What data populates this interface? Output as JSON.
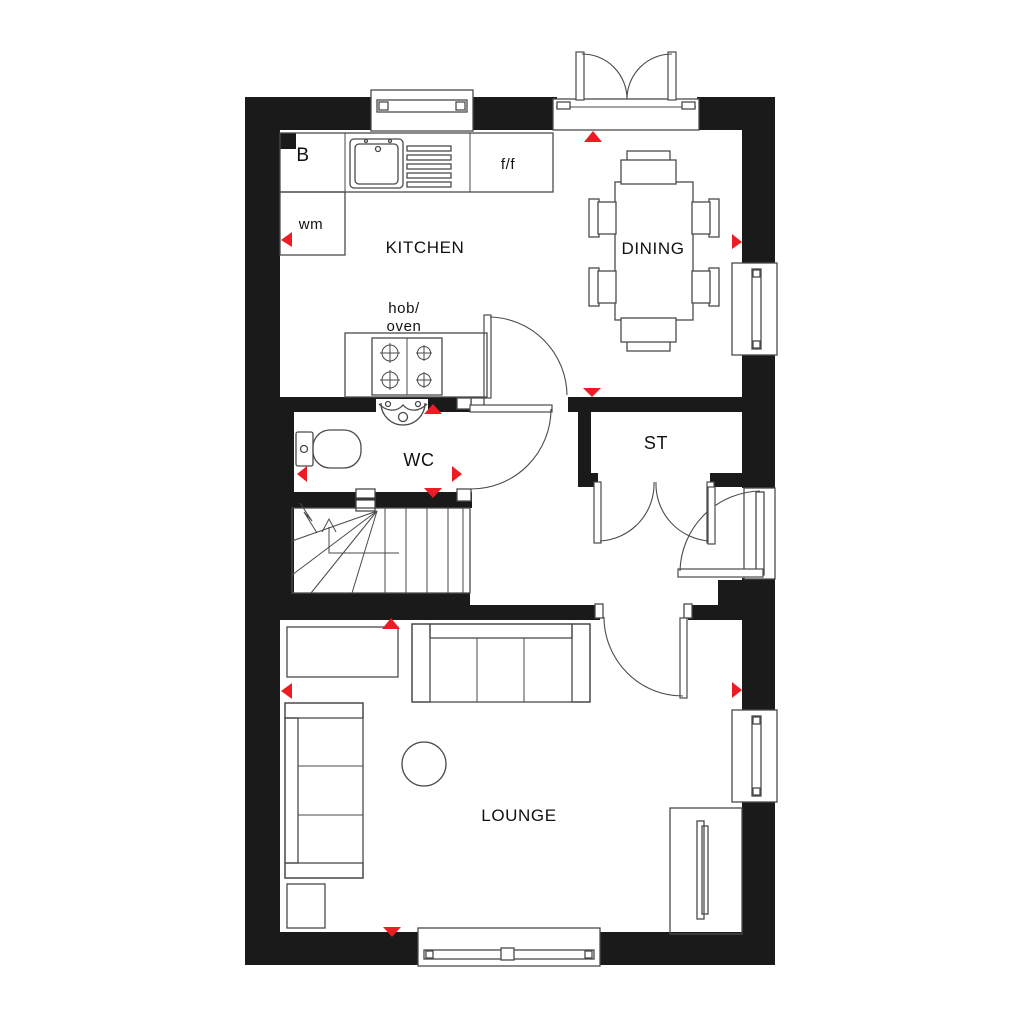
{
  "plan": {
    "title": "Ground floor plan",
    "rooms": [
      {
        "id": "kitchen",
        "label": "KITCHEN"
      },
      {
        "id": "dining",
        "label": "DINING"
      },
      {
        "id": "wc",
        "label": "WC"
      },
      {
        "id": "store",
        "label": "ST"
      },
      {
        "id": "lounge",
        "label": "LOUNGE"
      }
    ],
    "annotations": {
      "boiler": "B",
      "washing_machine": "wm",
      "fridge_freezer": "f/f",
      "hob_oven_line1": "hob/",
      "hob_oven_line2": "oven"
    },
    "colors": {
      "wall": "#1a1a1a",
      "line": "#4a4a4a",
      "marker": "#ec1c24",
      "background": "#ffffff"
    }
  }
}
